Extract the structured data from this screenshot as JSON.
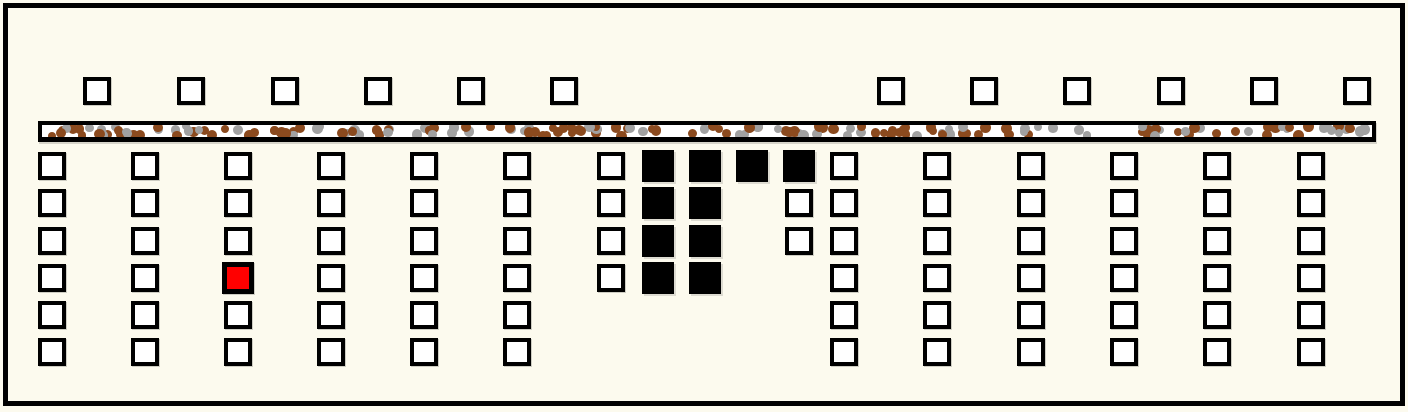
{
  "scene": {
    "width": 1408,
    "height": 412,
    "background": "#FCFAEE",
    "frame": {
      "x": 3,
      "y": 3,
      "width": 1402,
      "height": 403,
      "border_width": 5,
      "border_color": "#000000"
    }
  },
  "palette": {
    "cell_fill": "#FFFFFF",
    "cell_border": "#000000",
    "filled_cell": "#000000",
    "highlight_fill": "#FF0000",
    "highlight_border": "#000000",
    "strip_fill": "#FFFFFF",
    "strip_border": "#000000",
    "dot_brown": "#8B4A1E",
    "dot_gray": "#A1A1A1"
  },
  "top_row": {
    "y": 77,
    "cell_size": 28,
    "border_width": 4,
    "x_positions": [
      83,
      177,
      271,
      364,
      457,
      550,
      877,
      970,
      1063,
      1157,
      1250,
      1343
    ]
  },
  "speckle_strip": {
    "x": 38,
    "y": 121,
    "width": 1338,
    "height": 21,
    "border_width": 4,
    "bottom_border_width": 5,
    "dot_count": 185,
    "dot_radius_min": 4,
    "dot_radius_max": 5.5,
    "brown_fraction": 0.58,
    "seed": 7
  },
  "grid": {
    "cell_size": 28,
    "border_width": 4,
    "filled_cell_size": 32,
    "highlight_border_width": 5,
    "row_y": [
      152,
      189,
      227,
      264,
      301,
      338
    ],
    "columns": [
      {
        "x": 38,
        "cells": [
          "open",
          "open",
          "open",
          "open",
          "open",
          "open"
        ]
      },
      {
        "x": 131,
        "cells": [
          "open",
          "open",
          "open",
          "open",
          "open",
          "open"
        ]
      },
      {
        "x": 224,
        "cells": [
          "open",
          "open",
          "open",
          "highlight",
          "open",
          "open"
        ]
      },
      {
        "x": 317,
        "cells": [
          "open",
          "open",
          "open",
          "open",
          "open",
          "open"
        ]
      },
      {
        "x": 410,
        "cells": [
          "open",
          "open",
          "open",
          "open",
          "open",
          "open"
        ]
      },
      {
        "x": 503,
        "cells": [
          "open",
          "open",
          "open",
          "open",
          "open",
          "open"
        ]
      },
      {
        "x": 597,
        "cells": [
          "open",
          "open",
          "open",
          "open",
          "none",
          "none"
        ]
      },
      {
        "x": 644,
        "cells": [
          "filled",
          "filled",
          "filled",
          "filled",
          "none",
          "none"
        ]
      },
      {
        "x": 691,
        "cells": [
          "filled",
          "filled",
          "filled",
          "filled",
          "none",
          "none"
        ]
      },
      {
        "x": 738,
        "cells": [
          "filled",
          "none",
          "none",
          "none",
          "none",
          "none"
        ]
      },
      {
        "x": 785,
        "cells": [
          "filled",
          "open",
          "open",
          "none",
          "none",
          "none"
        ]
      },
      {
        "x": 830,
        "cells": [
          "open",
          "open",
          "open",
          "open",
          "open",
          "open"
        ]
      },
      {
        "x": 923,
        "cells": [
          "open",
          "open",
          "open",
          "open",
          "open",
          "open"
        ]
      },
      {
        "x": 1017,
        "cells": [
          "open",
          "open",
          "open",
          "open",
          "open",
          "open"
        ]
      },
      {
        "x": 1110,
        "cells": [
          "open",
          "open",
          "open",
          "open",
          "open",
          "open"
        ]
      },
      {
        "x": 1203,
        "cells": [
          "open",
          "open",
          "open",
          "open",
          "open",
          "open"
        ]
      },
      {
        "x": 1297,
        "cells": [
          "open",
          "open",
          "open",
          "open",
          "open",
          "open"
        ]
      }
    ]
  }
}
